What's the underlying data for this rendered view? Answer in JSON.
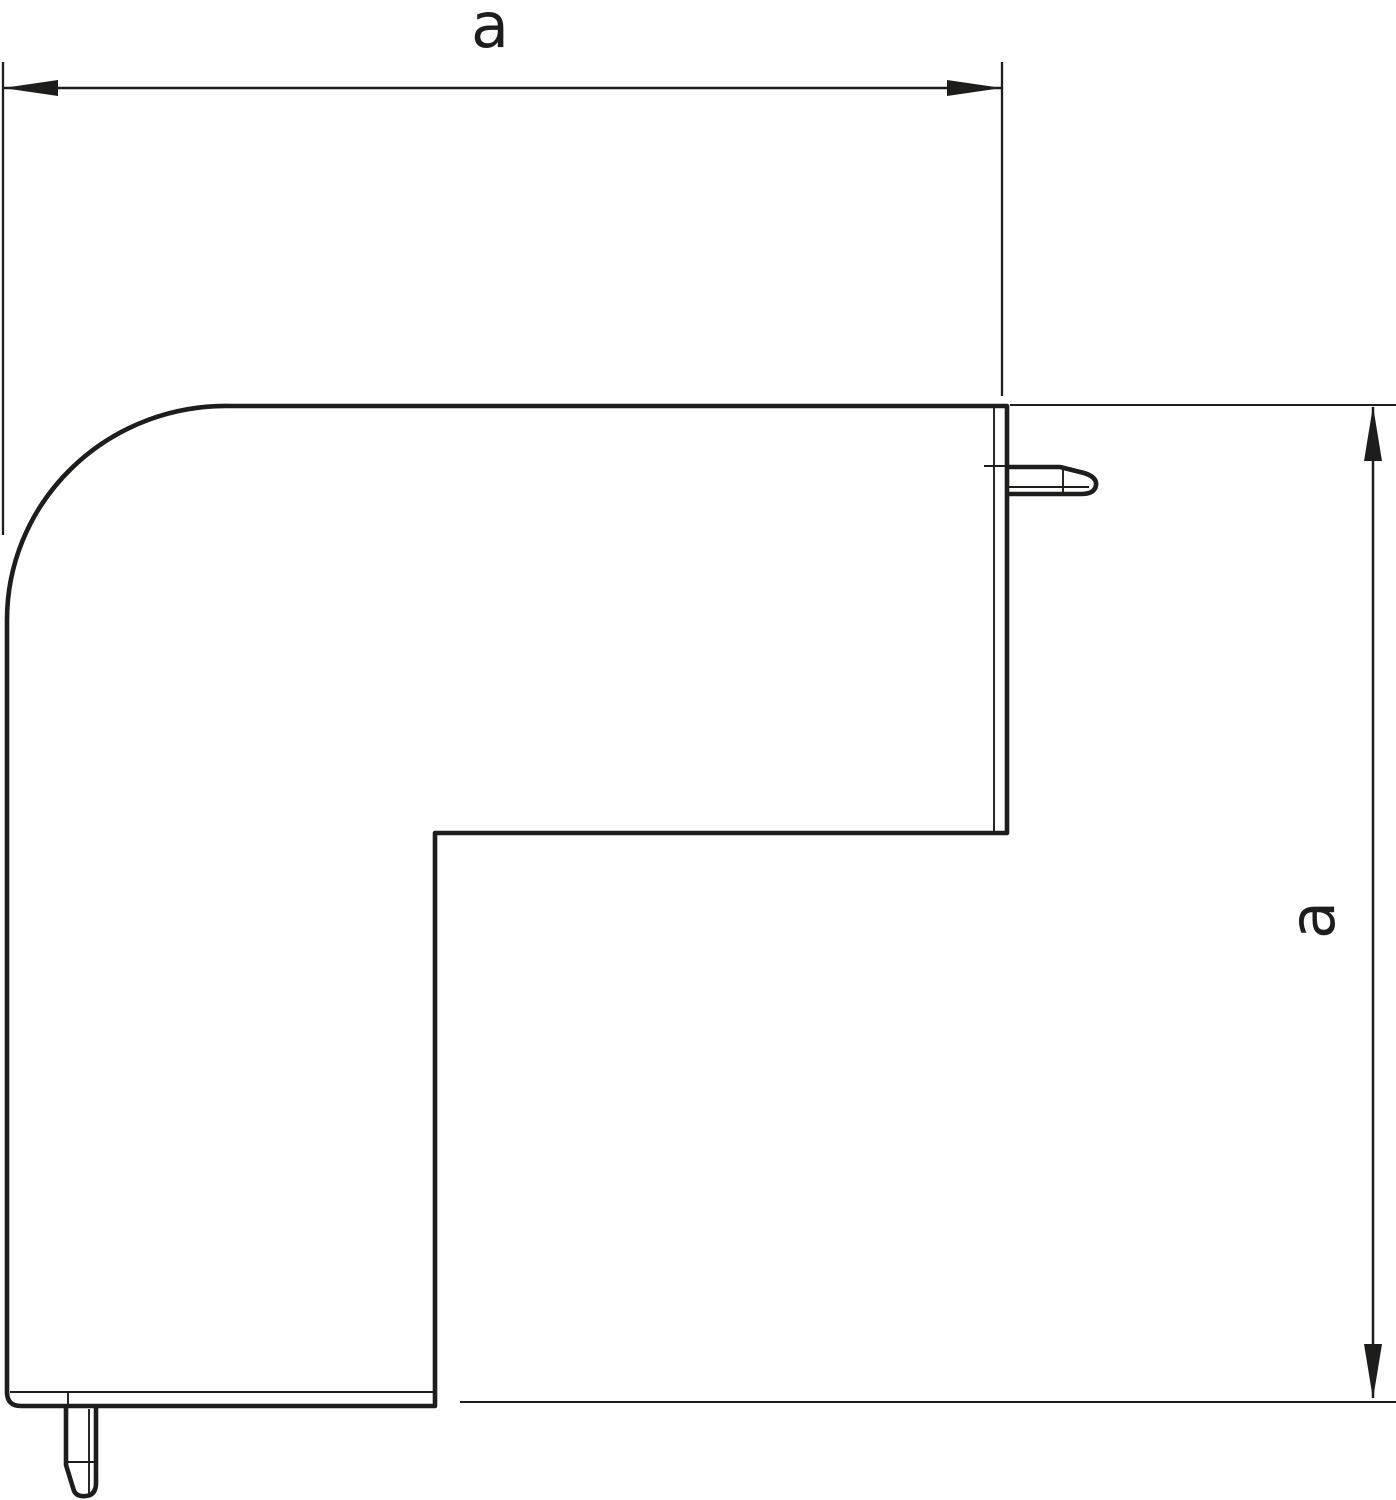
{
  "figure": {
    "background": "#ffffff",
    "line_color": "#1d1d1b"
  },
  "dimensions": {
    "width": {
      "label": "a"
    },
    "height": {
      "label": "a"
    }
  }
}
